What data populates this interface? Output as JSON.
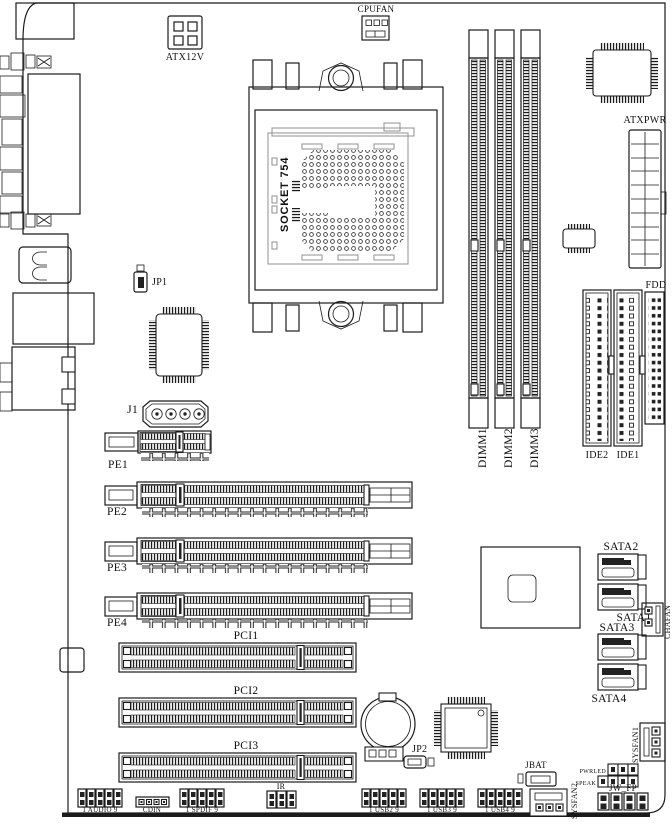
{
  "diagram_type": "motherboard-layout",
  "colors": {
    "line": "#1b1b1b",
    "socket_gray": "#9a9a9a",
    "background": "#ffffff"
  },
  "labels": {
    "atx12v": "ATX12V",
    "cpufan": "CPUFAN",
    "socket": "SOCKET 754",
    "jp1": "JP1",
    "jp2": "JP2",
    "jbat": "JBAT",
    "atxpwr": "ATXPWR",
    "fdd": "FDD",
    "dimm1": "DIMM1",
    "dimm2": "DIMM2",
    "dimm3": "DIMM3",
    "ide1": "IDE1",
    "ide2": "IDE2",
    "j1": "J1",
    "pe1": "PE1",
    "pe2": "PE2",
    "pe3": "PE3",
    "pe4": "PE4",
    "pci1": "PCI1",
    "pci2": "PCI2",
    "pci3": "PCI3",
    "sata1": "SATA1",
    "sata2": "SATA2",
    "sata3": "SATA3",
    "sata4": "SATA4",
    "chafan": "CHAFAN",
    "sysfan1": "SYSFAN1",
    "sysfan2": "SYSFAN2",
    "pwrled": "PWRLED",
    "speak": "SPEAK",
    "jwfp": "JW_FP",
    "ir": "IR",
    "audio": "1 AUDIO 9",
    "cdin": "CDIN",
    "spdif": "1 SPDIF 9",
    "usb2": "1 USB2 9",
    "usb3": "1 USB3 9",
    "usb4": "1 USB4 9"
  }
}
